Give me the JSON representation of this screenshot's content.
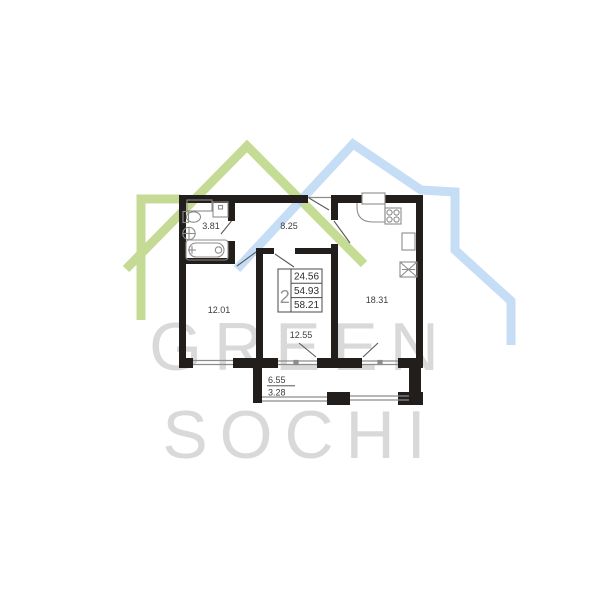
{
  "watermark": {
    "line1": "GREEN",
    "line2": "SOCHI"
  },
  "areas": {
    "bathroom": "3.81",
    "hallway": "8.25",
    "bedroom": "12.01",
    "living_room": "12.55",
    "kitchen_living": "18.31"
  },
  "balcony": {
    "area_full": "6.55",
    "area_reduced": "3.28"
  },
  "summary_table": {
    "rooms_count": "2",
    "row1": "24.56",
    "row2": "54.93",
    "row3": "58.21"
  },
  "colors": {
    "wall": "#221e1b",
    "thin_line": "#8c8c8c",
    "door_line": "#5a5a5a",
    "label_text": "#3d3d3d",
    "table_border": "#4a4a4a",
    "roof_green": "#b7d37b",
    "roof_blue": "#aecff2",
    "watermark_text": "#d9d9d9"
  }
}
